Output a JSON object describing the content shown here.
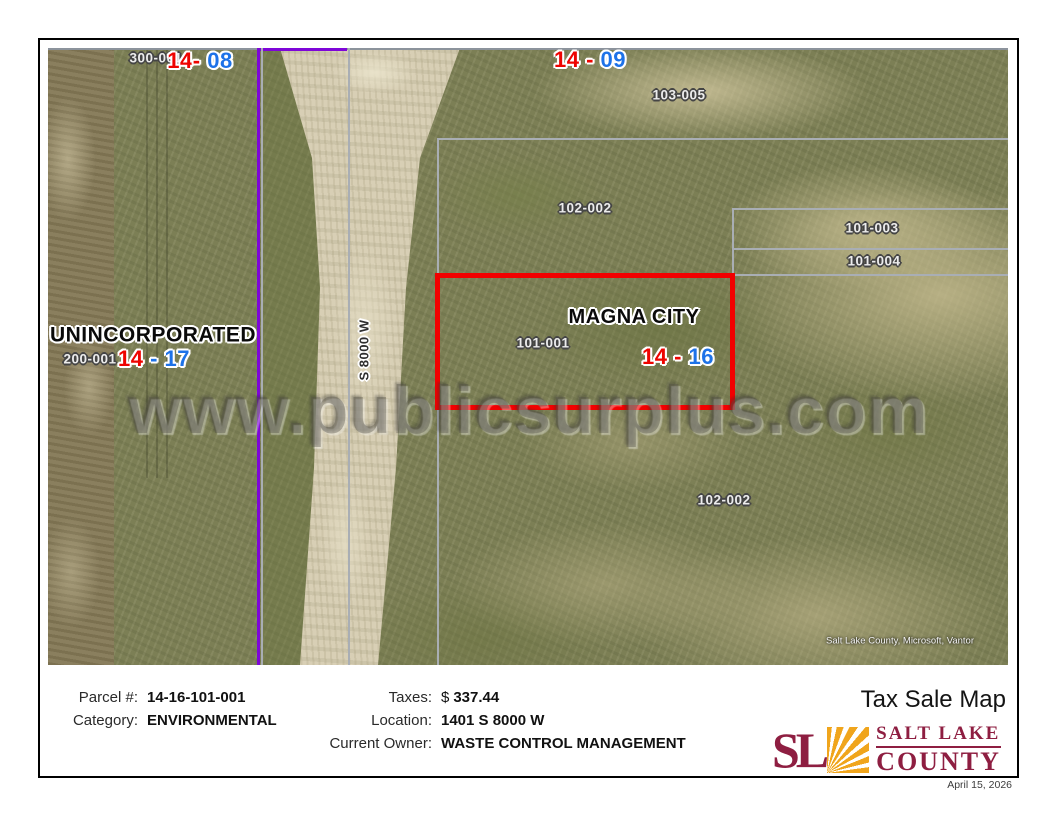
{
  "map": {
    "watermark": "www.publicsurplus.com",
    "attribution": "Salt Lake County, Microsoft, Vantor",
    "road_label": "S 8000 W",
    "area_labels": {
      "unincorporated": "UNINCORPORATED",
      "magna_city": "MAGNA CITY"
    },
    "parcel_labels": [
      "300-001",
      "103-005",
      "102-002",
      "101-003",
      "101-004",
      "101-001",
      "200-001",
      "102-002"
    ],
    "section_labels": [
      {
        "left": "14",
        "dash": "-",
        "right": "08"
      },
      {
        "left": "14",
        "dash": "-",
        "right": "09"
      },
      {
        "left": "14",
        "dash": "-",
        "right": "16"
      },
      {
        "left": "14",
        "dash": "-",
        "right": "17"
      }
    ]
  },
  "info": {
    "title": "Tax Sale Map",
    "fields": {
      "parcel": {
        "label": "Parcel #:",
        "value": "14-16-101-001"
      },
      "category": {
        "label": "Category:",
        "value": "ENVIRONMENTAL"
      },
      "taxes": {
        "label": "Taxes:",
        "currency": "$",
        "value": "337.44"
      },
      "location": {
        "label": "Location:",
        "value": "1401 S 8000 W"
      },
      "owner": {
        "label": "Current Owner:",
        "value": "WASTE CONTROL MANAGEMENT"
      }
    },
    "logo": {
      "monogram": "SL",
      "name_line1": "SALT LAKE",
      "name_line2": "COUNTY"
    },
    "date": "April 15, 2026"
  },
  "colors": {
    "section_red": "#ee0400",
    "section_blue": "#1d72e8",
    "boundary_gray": "#a9aeb4",
    "boundary_purple": "#7e06d8",
    "highlight_red": "#f20000",
    "logo_maroon": "#8e1e41",
    "logo_gold": "#f0a51c"
  }
}
